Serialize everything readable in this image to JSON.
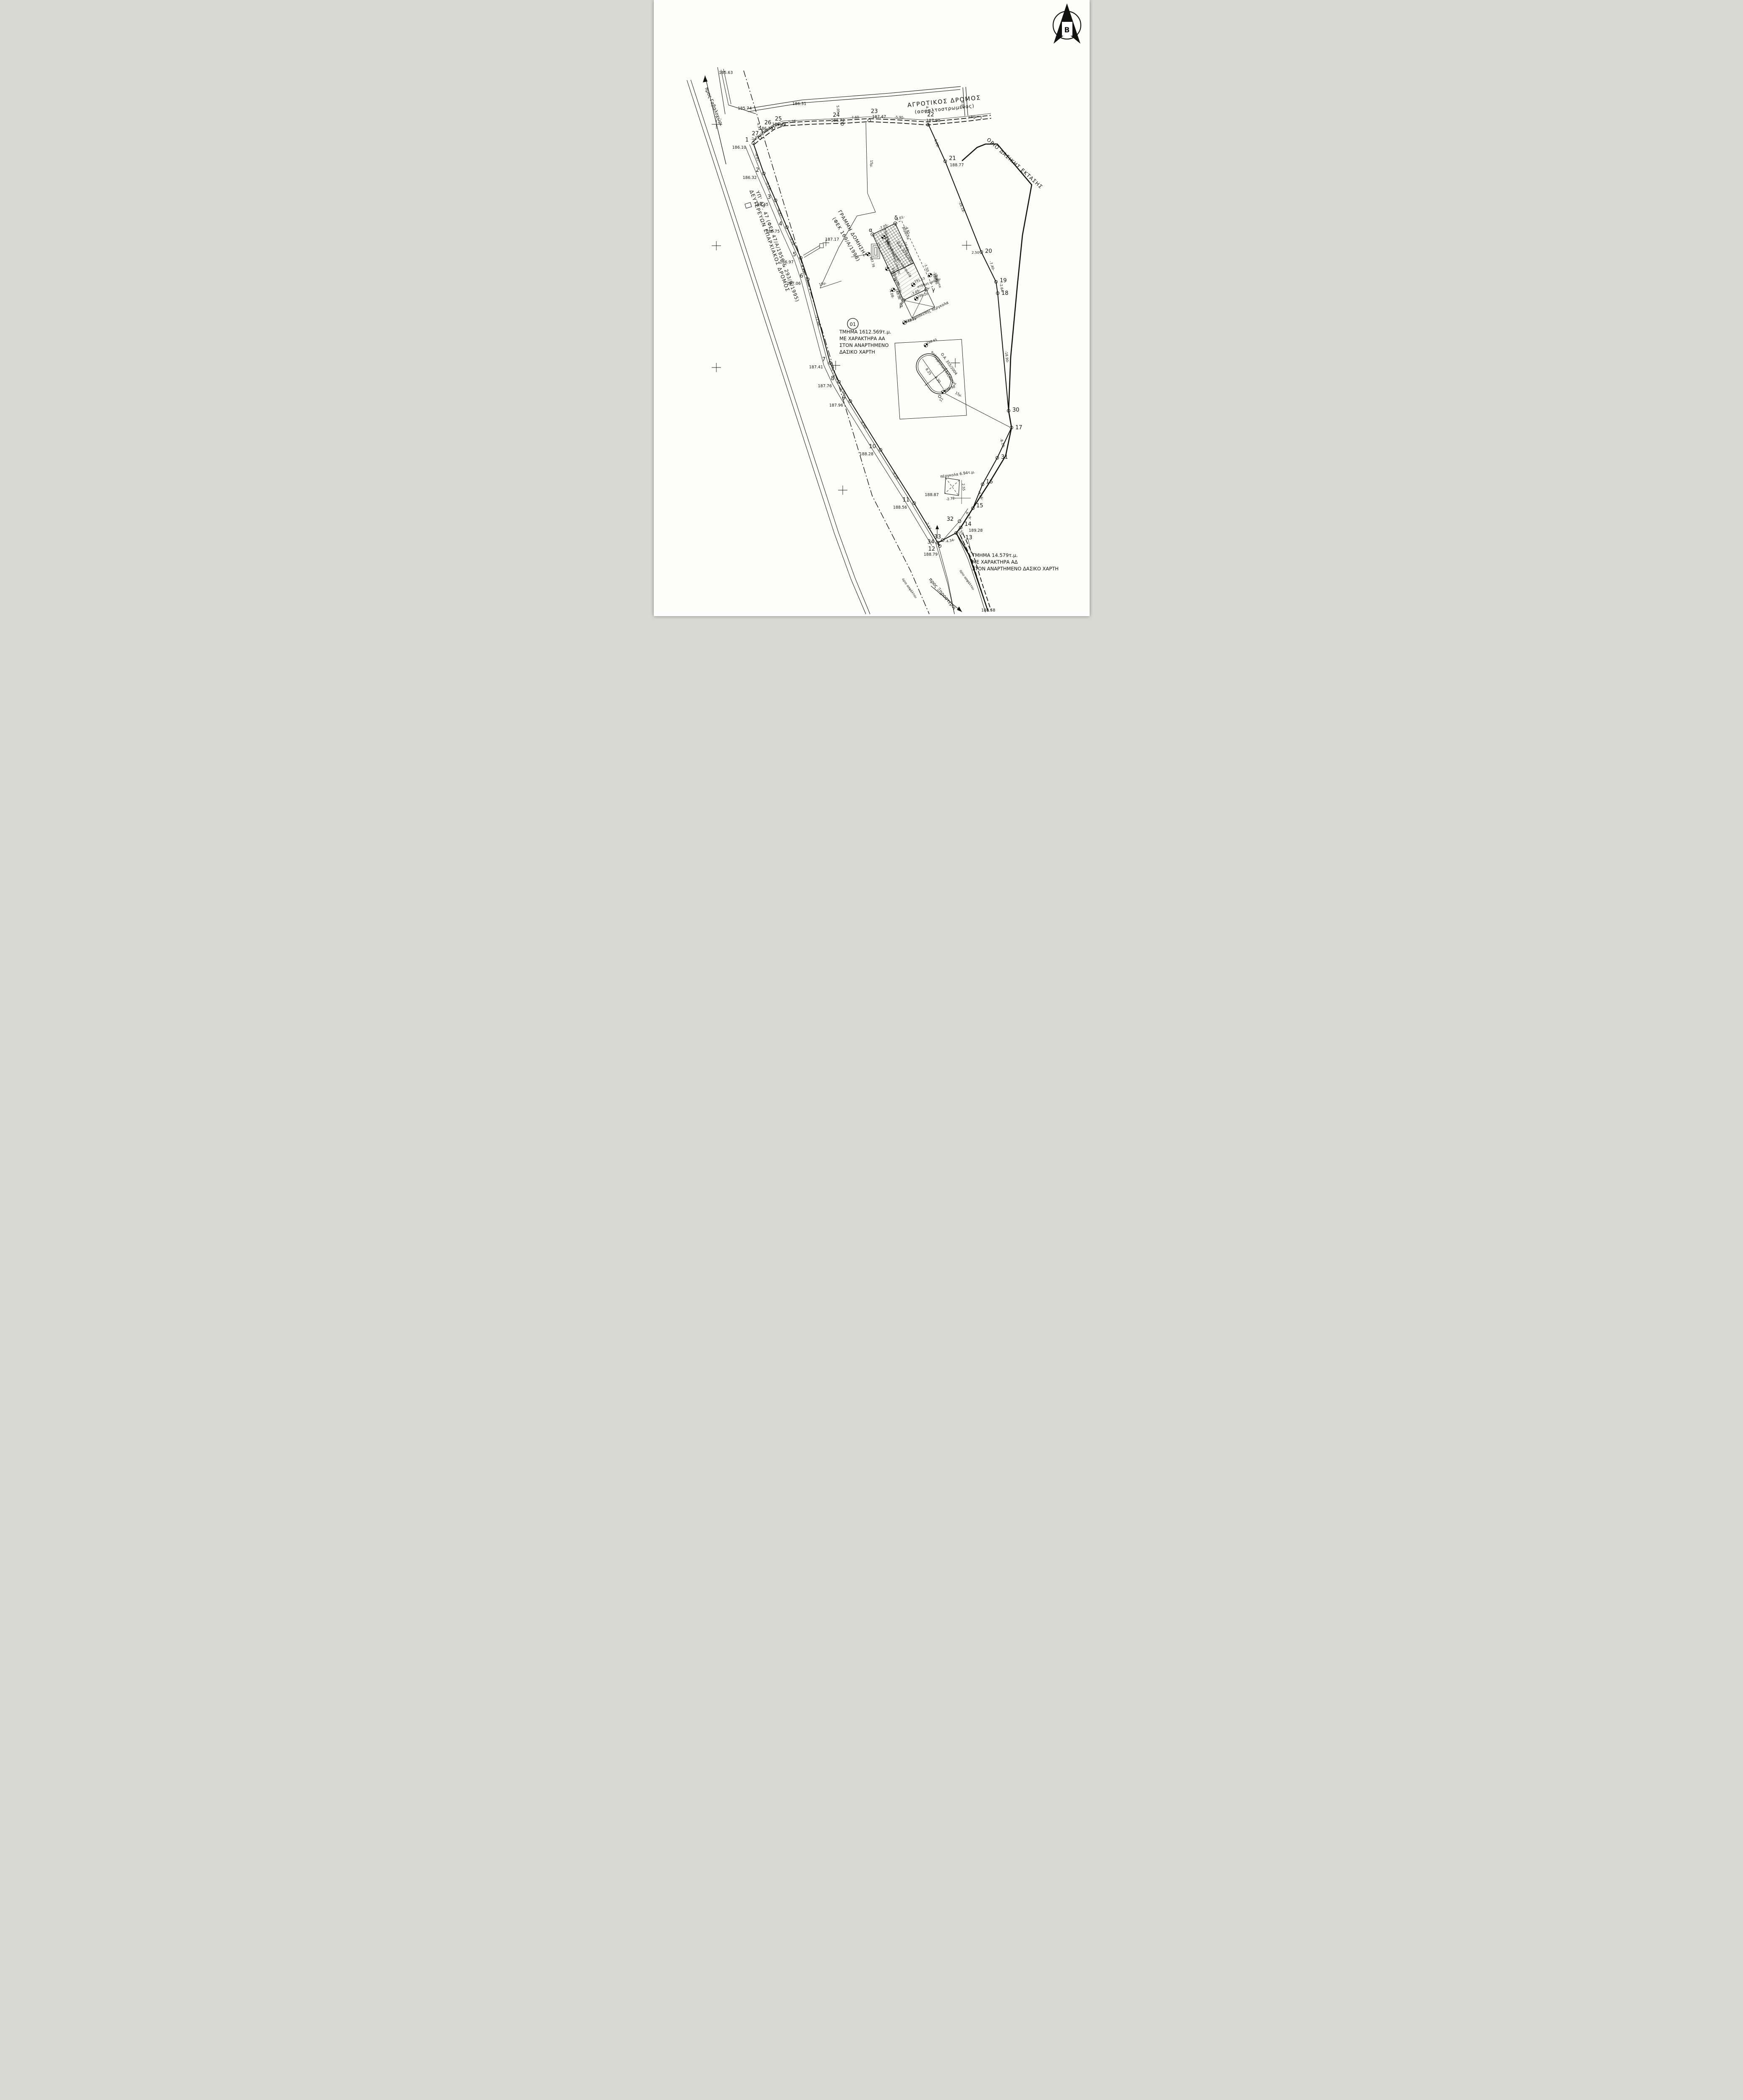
{
  "north": {
    "letter": "Β"
  },
  "roads": {
    "agrotikos1": "ΑΓΡΟΤΙΚΟΣ ΔΡΟΜΟΣ",
    "agrotikos2": "(ασφαλτοστρωμένος)",
    "eparchiakos1": "ΔΕΥΤΕΡΕΥΩΝ ΕΠΑΡΧΙΑΚΟΣ ΔΡΟΜΟΣ",
    "eparchiakos2": "ΥΠ' ΑΡ. 47 (ΦΕΚ 47/Α/1956 & 293/Β/1995)",
    "gavalochori": "προς Γαβαλοχώρι",
    "xirosterni": "προς Ξηροστέρνι",
    "orio_asfaltou": "όριο ασφάλτου",
    "orio_dasikis": "ΟΡΙΟ ΔΑΣΙΚΗΣ ΕΚΤΑΣΗΣ"
  },
  "setback": {
    "line1": "ΓΡΑΜΜΗ ΔΟΜΗΣΗΣ",
    "line2": "(ΦΕΚ 169/Α/1998)",
    "offset15": "15μ."
  },
  "sections": {
    "s1": {
      "id": "01",
      "l1": "ΤΜΗΜΑ 1612.569τ.μ.",
      "l2": "ΜΕ ΧΑΡΑΚΤΗΡΑ ΑΑ",
      "l3": "ΣΤΟΝ ΑΝΑΡΤΗΜΕΝΟ",
      "l4": "ΔΑΣΙΚΟ ΧΑΡΤΗ"
    },
    "s2": {
      "l1": "ΤΜΗΜΑ 14.579τ.μ.",
      "l2": "ΜΕ ΧΑΡΑΚΤΗΡΑ ΑΔ",
      "l3": "ΣΤΟΝ ΑΝΑΡΤΗΜΕΝΟ ΔΑΣΙΚΟ ΧΑΡΤΗ"
    }
  },
  "house": {
    "type": "2ΙΚ - διώροφη κατοικία",
    "permit": "Ο.Α. 379/2003",
    "veranda": "βεράντα",
    "veranda_elev": "188.36",
    "roof_label": "κορυφή κεραμοσκεπής στέγης",
    "roof_elev": "193.23",
    "ground_label": "στάθμη ισογείου",
    "ground_elev": "188.38",
    "floor_label": "στάθμη ορόφου",
    "floor_elev": "191.53",
    "pergola_label": "κεραμοσκεπής πέργκολα",
    "pergola_elev": "188.20",
    "terrace_elev": "188.25",
    "west_elev": "187.78",
    "corner_a": "α",
    "corner_b": "β",
    "corner_c": "γ",
    "corner_d": "δ"
  },
  "pool": {
    "name1": "κολυμβητική δεξαμενή",
    "name2": "Ο.Α. 355/2004",
    "len": "8.25",
    "wid": "4.30",
    "s1": "Σ1",
    "elev_se": "188.98",
    "elev_n": "188.65"
  },
  "pergola": {
    "label": "πέργκολα 6.94τ.μ.",
    "w": "-2.72-",
    "h": "2.55",
    "elev": "188.87"
  },
  "points": {
    "p1": {
      "n": "1",
      "elev": "186.10"
    },
    "p2": {
      "n": "2",
      "elev": "186.32"
    },
    "p3": {
      "n": "3",
      "elev": "186.45"
    },
    "p4": {
      "n": "4",
      "elev": "186.75"
    },
    "p5": {
      "n": "5",
      "elev": "186.97"
    },
    "p6": {
      "n": "6",
      "elev": "187.06"
    },
    "p7": {
      "n": "7",
      "elev": "187.41"
    },
    "p8": {
      "n": "8",
      "elev": "187.76"
    },
    "p9": {
      "n": "9",
      "elev": "187.96"
    },
    "p10": {
      "n": "10",
      "elev": "188.28"
    },
    "p11": {
      "n": "11",
      "elev": "188.56"
    },
    "p12": {
      "n": "12",
      "elev": "188.79"
    },
    "p13": {
      "n": "13"
    },
    "p14": {
      "n": "14",
      "elev": "189.28"
    },
    "p15": {
      "n": "15"
    },
    "p16": {
      "n": "16"
    },
    "p17": {
      "n": "17"
    },
    "p18": {
      "n": "18"
    },
    "p19": {
      "n": "19"
    },
    "p20": {
      "n": "20"
    },
    "p21": {
      "n": "21",
      "elev": "188.77"
    },
    "p22": {
      "n": "22",
      "elev": "187.98"
    },
    "p23": {
      "n": "23",
      "elev": "187.47"
    },
    "p24": {
      "n": "24",
      "elev": "186.72"
    },
    "p25": {
      "n": "25",
      "elev": "186.49"
    },
    "p26": {
      "n": "26",
      "elev": "186.20"
    },
    "p27": {
      "n": "27"
    },
    "p30": {
      "n": "30"
    },
    "p31": {
      "n": "31"
    },
    "p32": {
      "n": "32"
    },
    "p33": {
      "n": "33"
    },
    "p34": {
      "n": "34"
    }
  },
  "distances": {
    "d_1_27": "-2.22-",
    "d_27_26": "-3.09-",
    "d_26_25": "-3.73-",
    "d_25_24": "-5.26-",
    "d_24_23": "-7.60-",
    "d_23_22": "-5.90-",
    "w_431": "4.31",
    "w_505": "5.05",
    "w_471": "4.71",
    "w_501": "5.01",
    "d_22_21": "-6.26-",
    "d_21_20": "-16.18-",
    "w_250": "2.50",
    "d_20_19": "-7.40-",
    "d_19_18": "-2.64-",
    "d_18_30": "-18.90-",
    "d_17_31": "-8.19-",
    "d_16_15": "-4.66-",
    "d_15_32": "-4.19-",
    "d_14_13": "1.55",
    "d_33_13": "-4.34-",
    "d_1_2": "-4.87-",
    "d_2_3": "-5.19-",
    "d_3_4": "-4.87-",
    "d_4_5": "-5.18-",
    "d_5_6": "-4.93-",
    "d_6_7": "-11.86-",
    "d_7_8": "-5.13-",
    "d_8_9": "-5.54-",
    "d_9_10": "-8.40-",
    "d_10_11": "-9.24-",
    "d_11_12": "-7.17-",
    "dim_top": "-7.05-",
    "dim_veranda_w": "-2.01-",
    "dim_veranda_l": "-4.81-",
    "dim_816": "-8.16-",
    "dim_1060": "-10.60-",
    "dim_150": "-1.50",
    "dim_bottom": "-7.05-",
    "dim_120": "-1.20",
    "dim_408": "-4.08-",
    "dim_364": "-3.64-"
  },
  "elevations": {
    "e_18563": "185.63",
    "e_18574": "185.74",
    "e_18631": "186.31",
    "e_18908": "189.08",
    "e_18717": "187.17",
    "e_18858": "188.58"
  }
}
